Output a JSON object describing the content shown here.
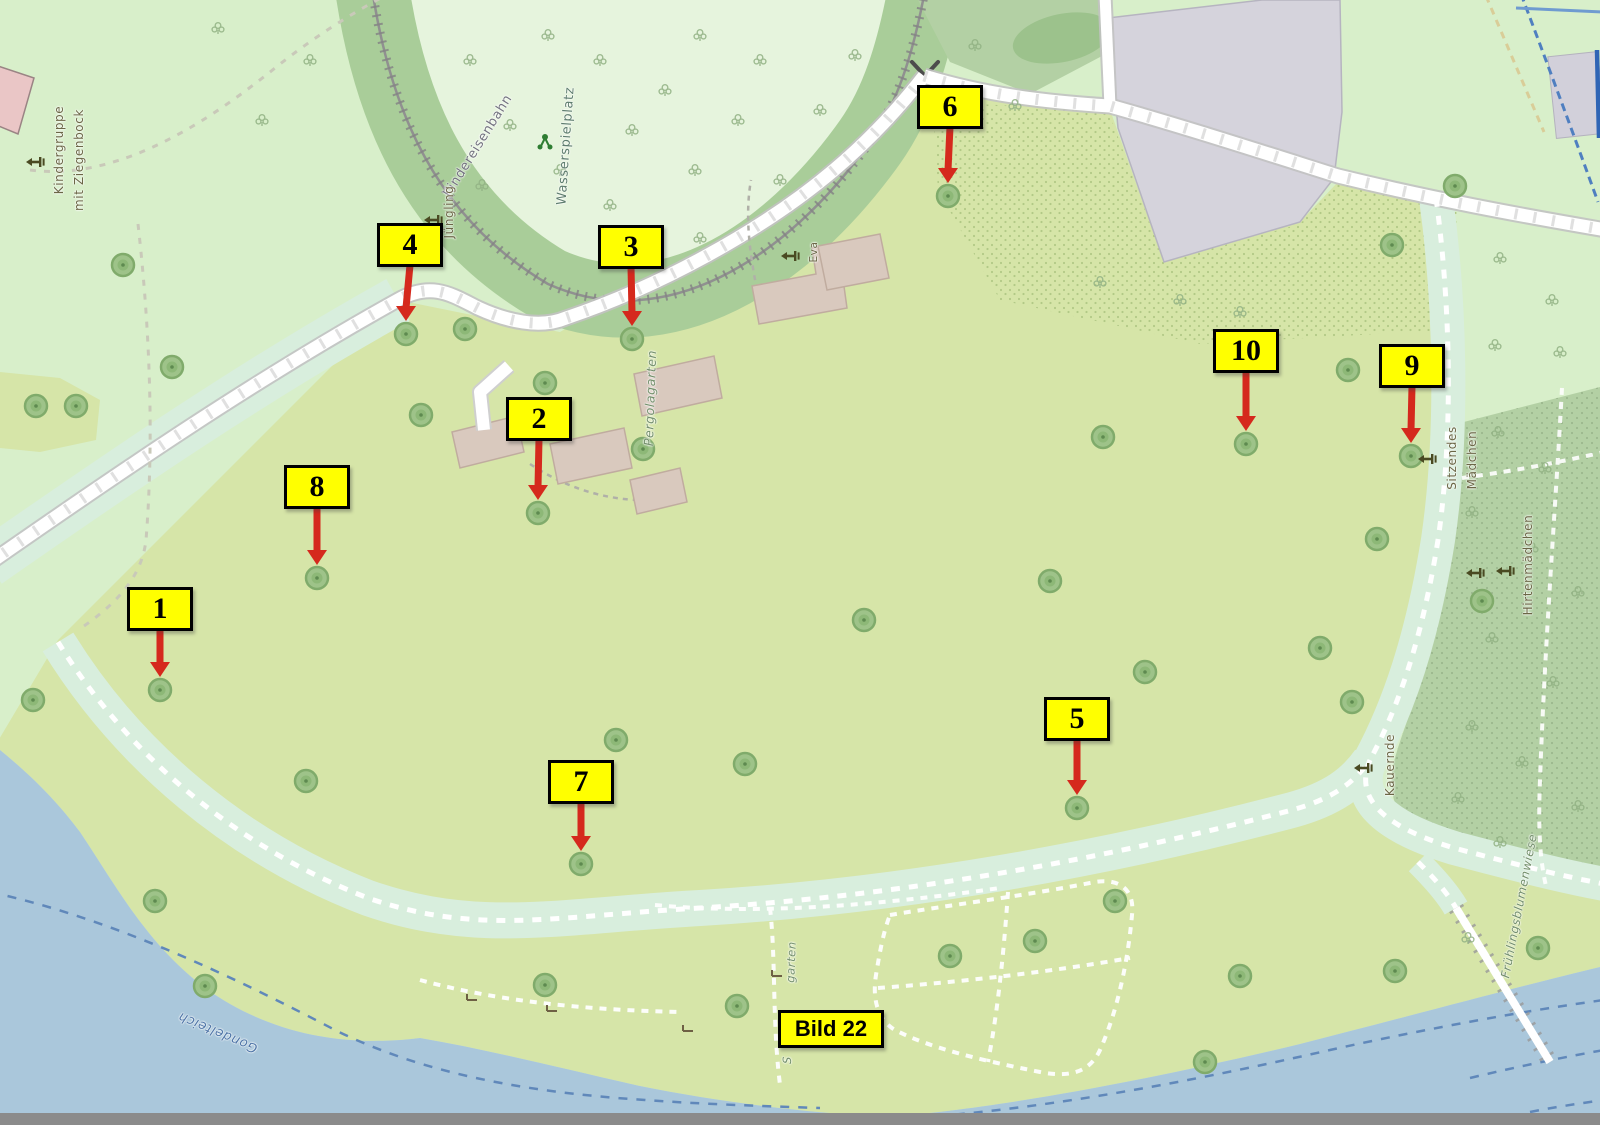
{
  "annotation": {
    "markers": [
      {
        "label": "1",
        "box_x": 160,
        "box_y": 609,
        "target_x": 160,
        "target_y": 690
      },
      {
        "label": "2",
        "box_x": 539,
        "box_y": 419,
        "target_x": 538,
        "target_y": 513
      },
      {
        "label": "3",
        "box_x": 631,
        "box_y": 247,
        "target_x": 632,
        "target_y": 339
      },
      {
        "label": "4",
        "box_x": 410,
        "box_y": 245,
        "target_x": 406,
        "target_y": 334
      },
      {
        "label": "5",
        "box_x": 1077,
        "box_y": 719,
        "target_x": 1077,
        "target_y": 808
      },
      {
        "label": "6",
        "box_x": 950,
        "box_y": 107,
        "target_x": 948,
        "target_y": 196
      },
      {
        "label": "7",
        "box_x": 581,
        "box_y": 782,
        "target_x": 581,
        "target_y": 864
      },
      {
        "label": "8",
        "box_x": 317,
        "box_y": 487,
        "target_x": 317,
        "target_y": 578
      },
      {
        "label": "9",
        "box_x": 1412,
        "box_y": 366,
        "target_x": 1411,
        "target_y": 456
      },
      {
        "label": "10",
        "box_x": 1246,
        "box_y": 351,
        "target_x": 1246,
        "target_y": 444
      }
    ],
    "marker_box": {
      "width": 66,
      "height": 44
    },
    "image_label": {
      "text": "Bild 22",
      "x": 831,
      "y": 1029,
      "width": 106,
      "height": 38
    },
    "style": {
      "box_fill": "#ffff00",
      "box_border": "#000000",
      "arrow_color": "#d5291d"
    }
  },
  "map": {
    "palette": {
      "water": "#aac7db",
      "meadow": "#d6e5a8",
      "base_green": "#d8efca",
      "wood": "#a9cd99",
      "forest": "#b3d0a4",
      "building": "#d5d3dc",
      "hut": "#d9c9be"
    },
    "labels": [
      {
        "text": "Kindergruppe",
        "x": 59,
        "y": 150,
        "rot": -90,
        "color": "#6b6746",
        "size": 12,
        "it": false
      },
      {
        "text": "mit Ziegenbock",
        "x": 79,
        "y": 160,
        "rot": -90,
        "color": "#6b6746",
        "size": 12,
        "it": false
      },
      {
        "text": "Kindereisenbahn",
        "x": 478,
        "y": 146,
        "rot": -58,
        "color": "#73737f",
        "size": 13,
        "it": false
      },
      {
        "text": "Wasserspielplatz",
        "x": 566,
        "y": 146,
        "rot": -86,
        "color": "#5e7d6e",
        "size": 13,
        "it": false
      },
      {
        "text": "Jüngling",
        "x": 449,
        "y": 212,
        "rot": -90,
        "color": "#6b6746",
        "size": 12,
        "it": false
      },
      {
        "text": "Eva",
        "x": 814,
        "y": 252,
        "rot": -90,
        "color": "#6b6746",
        "size": 10.5,
        "it": false
      },
      {
        "text": "Pergolagarten",
        "x": 650,
        "y": 398,
        "rot": -88,
        "color": "#74906c",
        "size": 12.5,
        "it": true
      },
      {
        "text": "Sitzendes",
        "x": 1452,
        "y": 458,
        "rot": -90,
        "color": "#6b6746",
        "size": 12,
        "it": false
      },
      {
        "text": "Mädchen",
        "x": 1472,
        "y": 460,
        "rot": -90,
        "color": "#6b6746",
        "size": 12,
        "it": false
      },
      {
        "text": "Hirtenmädchen",
        "x": 1528,
        "y": 565,
        "rot": -90,
        "color": "#6b6746",
        "size": 12,
        "it": false
      },
      {
        "text": "Kauernde",
        "x": 1390,
        "y": 765,
        "rot": -90,
        "color": "#6b6746",
        "size": 12,
        "it": false
      },
      {
        "text": "Frühlingsblumenwiese",
        "x": 1519,
        "y": 906,
        "rot": -79,
        "color": "#74906c",
        "size": 12,
        "it": true
      },
      {
        "text": "Gondelteich",
        "x": 218,
        "y": 1032,
        "rot": 203,
        "color": "#4f76a8",
        "size": 13,
        "it": true
      },
      {
        "text": "garten",
        "x": 791,
        "y": 962,
        "rot": -88,
        "color": "#74906c",
        "size": 11.5,
        "it": true
      },
      {
        "text": "S",
        "x": 787,
        "y": 1060,
        "rot": -88,
        "color": "#74906c",
        "size": 11.5,
        "it": true
      }
    ],
    "trees": [
      [
        160,
        690
      ],
      [
        538,
        513
      ],
      [
        632,
        339
      ],
      [
        406,
        334
      ],
      [
        1077,
        808
      ],
      [
        948,
        196
      ],
      [
        581,
        864
      ],
      [
        317,
        578
      ],
      [
        1411,
        456
      ],
      [
        1246,
        444
      ],
      [
        123,
        265
      ],
      [
        172,
        367
      ],
      [
        36,
        406
      ],
      [
        76,
        406
      ],
      [
        465,
        329
      ],
      [
        421,
        415
      ],
      [
        643,
        449
      ],
      [
        545,
        383
      ],
      [
        864,
        620
      ],
      [
        745,
        764
      ],
      [
        616,
        740
      ],
      [
        306,
        781
      ],
      [
        33,
        700
      ],
      [
        155,
        901
      ],
      [
        205,
        986
      ],
      [
        545,
        985
      ],
      [
        737,
        1006
      ],
      [
        1050,
        581
      ],
      [
        1103,
        437
      ],
      [
        1145,
        672
      ],
      [
        1348,
        370
      ],
      [
        1377,
        539
      ],
      [
        1320,
        648
      ],
      [
        1352,
        702
      ],
      [
        1455,
        186
      ],
      [
        1392,
        245
      ],
      [
        950,
        956
      ],
      [
        1035,
        941
      ],
      [
        1115,
        901
      ],
      [
        1240,
        976
      ],
      [
        1395,
        971
      ],
      [
        1538,
        948
      ],
      [
        1482,
        601
      ],
      [
        1205,
        1062
      ]
    ],
    "statues": [
      [
        35,
        162
      ],
      [
        433,
        220
      ],
      [
        790,
        256
      ],
      [
        1427,
        459
      ],
      [
        1475,
        573
      ],
      [
        1505,
        571
      ],
      [
        1363,
        768
      ]
    ],
    "benches": [
      [
        472,
        997
      ],
      [
        552,
        1008
      ],
      [
        688,
        1028
      ],
      [
        777,
        973
      ]
    ],
    "playground_icon": {
      "x": 545,
      "y": 142
    },
    "shrubs": [
      [
        470,
        60
      ],
      [
        510,
        125
      ],
      [
        482,
        185
      ],
      [
        548,
        35
      ],
      [
        560,
        170
      ],
      [
        600,
        60
      ],
      [
        632,
        130
      ],
      [
        610,
        205
      ],
      [
        665,
        90
      ],
      [
        700,
        35
      ],
      [
        695,
        170
      ],
      [
        738,
        120
      ],
      [
        760,
        60
      ],
      [
        780,
        180
      ],
      [
        820,
        110
      ],
      [
        855,
        55
      ],
      [
        700,
        238
      ],
      [
        640,
        252
      ],
      [
        218,
        28
      ],
      [
        262,
        120
      ],
      [
        310,
        60
      ],
      [
        975,
        45
      ],
      [
        1015,
        105
      ],
      [
        1180,
        300
      ],
      [
        1240,
        312
      ],
      [
        1100,
        282
      ],
      [
        1500,
        258
      ],
      [
        1552,
        300
      ],
      [
        1495,
        345
      ],
      [
        1560,
        352
      ],
      [
        1498,
        432
      ],
      [
        1545,
        468
      ],
      [
        1472,
        512
      ],
      [
        1532,
        548
      ],
      [
        1578,
        592
      ],
      [
        1492,
        638
      ],
      [
        1553,
        682
      ],
      [
        1472,
        726
      ],
      [
        1522,
        762
      ],
      [
        1578,
        806
      ],
      [
        1458,
        798
      ],
      [
        1500,
        842
      ],
      [
        1468,
        938
      ]
    ]
  }
}
